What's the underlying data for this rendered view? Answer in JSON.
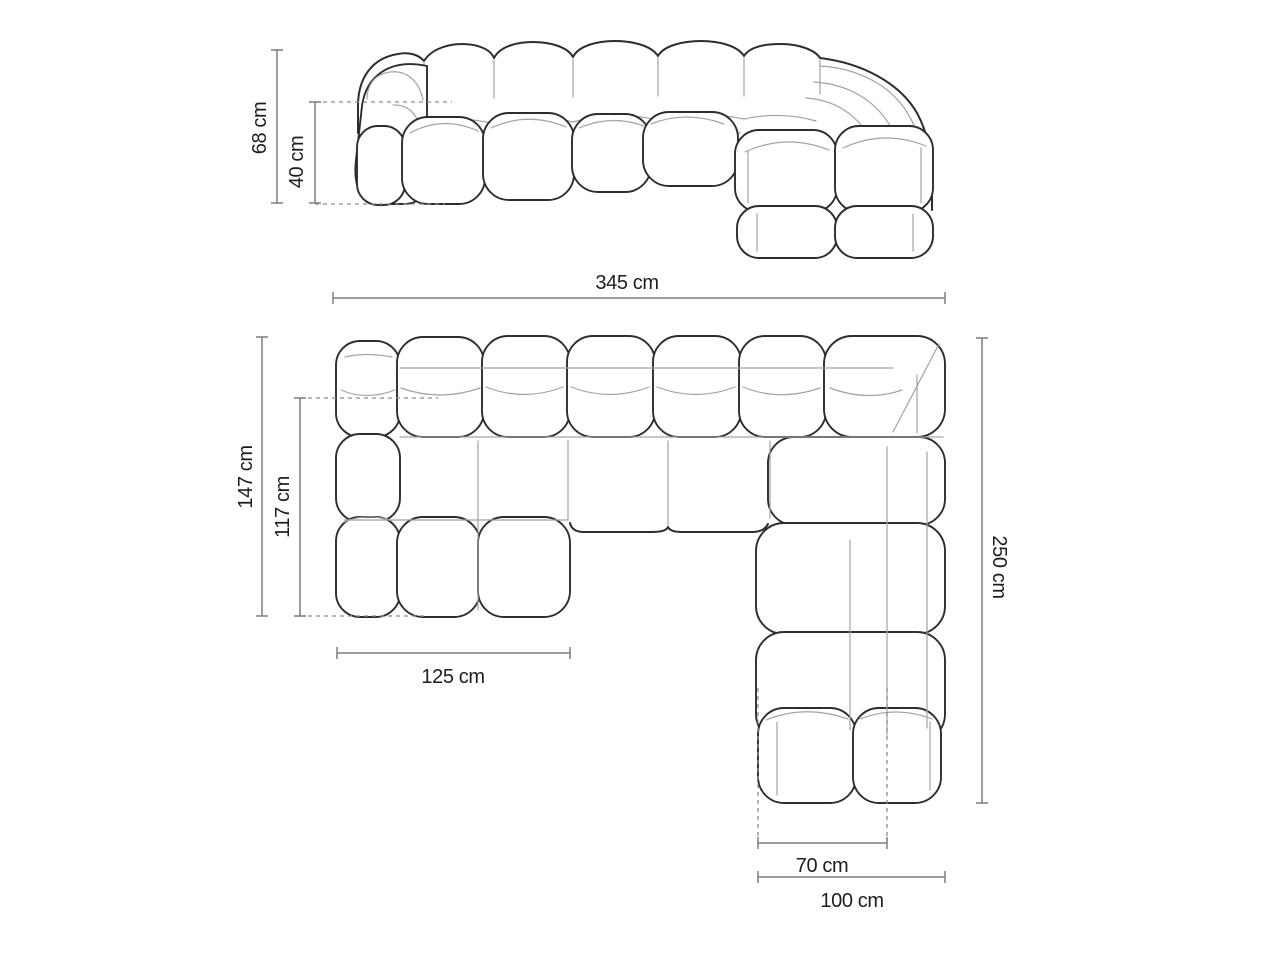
{
  "diagram": {
    "unit": "cm",
    "colors": {
      "background": "#ffffff",
      "outline": "#2d2d2d",
      "inner_seam": "#a3a3a3",
      "dimension_line": "#7d7d7d",
      "dashed_line": "#8c8c8c",
      "text": "#1e1e1e"
    },
    "front_view": {
      "height_total": "68 cm",
      "height_seat": "40 cm",
      "width_total": "345 cm"
    },
    "top_view": {
      "depth_total": "147 cm",
      "depth_seat": "117 cm",
      "chaise_width": "125 cm",
      "side_length": "250 cm",
      "front_width_inner": "70 cm",
      "front_width_outer": "100 cm"
    }
  }
}
